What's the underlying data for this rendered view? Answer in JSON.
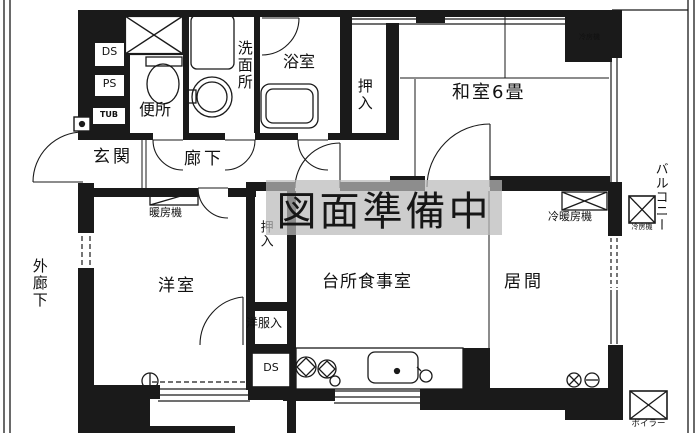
{
  "page": {
    "type": "japanese-apartment-floor-plan"
  },
  "watermark": {
    "text": "図面準備中"
  },
  "labels": {
    "ds_top": "DS",
    "ps": "PS",
    "tub": "TUB",
    "toilet": "便所",
    "washroom": "洗面所",
    "bath": "浴室",
    "closet_top": "押入",
    "japanese_room": "和室6畳",
    "cooler_tatami": "冷房機",
    "entrance": "玄関",
    "hallway": "廊下",
    "heater": "暖房機",
    "closet_mid": "押入",
    "western_room": "洋室",
    "wardrobe": "洋服入",
    "ds_bottom": "DS",
    "kitchen_dining": "台所食事室",
    "living": "居間",
    "ac_heater": "冷暖房機",
    "cooler_balcony": "冷房機",
    "boiler": "ボイラー",
    "balcony": "バルコニー",
    "outer_corridor": "外廊下"
  },
  "colors": {
    "line": "#1a1a1a",
    "background": "#ffffff",
    "watermark_band": "#bababa",
    "watermark_text": "#161616"
  }
}
